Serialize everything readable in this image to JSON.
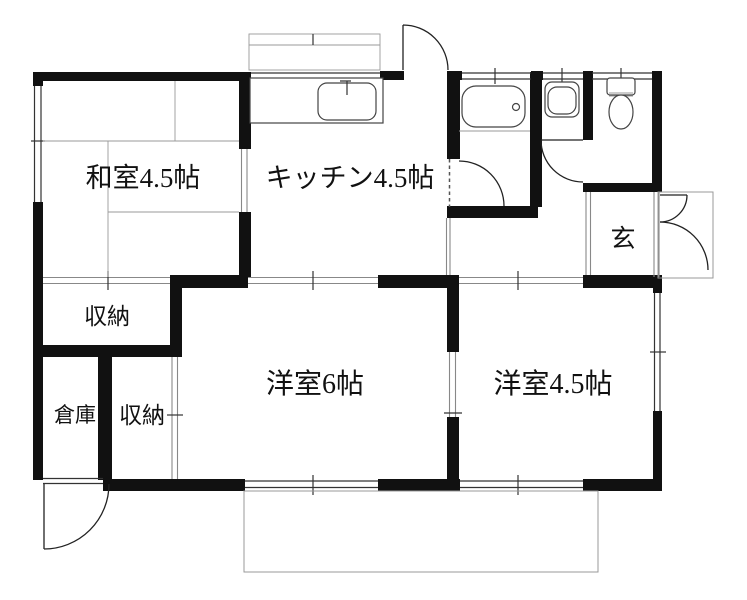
{
  "plan": {
    "title": "floor-plan",
    "rooms": {
      "washitsu": {
        "label": "和室4.5帖"
      },
      "kitchen": {
        "label": "キッチン4.5帖"
      },
      "genkan": {
        "label": "玄"
      },
      "closet_upper": {
        "label": "収納"
      },
      "souko": {
        "label": "倉庫"
      },
      "closet_lower": {
        "label": "収納"
      },
      "western6": {
        "label": "洋室6帖"
      },
      "western45": {
        "label": "洋室4.5帖"
      }
    },
    "fixtures": [
      "bathtub",
      "washbasin",
      "toilet",
      "kitchen-sink",
      "bay-window"
    ],
    "colors": {
      "wall": "#111111",
      "line": "#333333",
      "light_line": "#888888",
      "bg": "#ffffff"
    }
  }
}
